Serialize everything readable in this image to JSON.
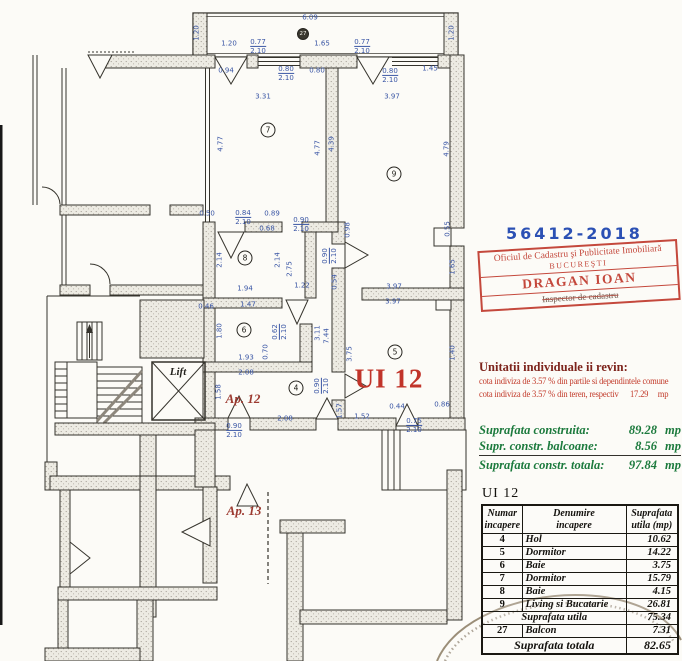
{
  "plan": {
    "labels": [
      {
        "text": "UI 12",
        "x": 389,
        "y": 379,
        "kind": "unit-label"
      },
      {
        "text": "Ap. 12",
        "x": 243,
        "y": 399,
        "kind": "apt-label"
      },
      {
        "text": "Ap. 13",
        "x": 244,
        "y": 511,
        "kind": "apt-label"
      },
      {
        "text": "Lift",
        "x": 178,
        "y": 372,
        "kind": "lift-label"
      }
    ],
    "rooms": [
      {
        "n": "27",
        "x": 303,
        "y": 34
      },
      {
        "n": "7",
        "x": 268,
        "y": 130
      },
      {
        "n": "9",
        "x": 394,
        "y": 174
      },
      {
        "n": "8",
        "x": 245,
        "y": 258
      },
      {
        "n": "6",
        "x": 244,
        "y": 330
      },
      {
        "n": "4",
        "x": 296,
        "y": 388
      },
      {
        "n": "5",
        "x": 395,
        "y": 352
      }
    ],
    "dimensions": [
      {
        "t": "6.09",
        "x": 310,
        "y": 18
      },
      {
        "t": "1.20",
        "x": 197,
        "y": 33,
        "r": 1
      },
      {
        "t": "1.20",
        "x": 452,
        "y": 33,
        "r": 1
      },
      {
        "t": "1.20",
        "x": 229,
        "y": 44
      },
      {
        "t": "0.77",
        "b": "2.10",
        "x": 258,
        "y": 47
      },
      {
        "t": "1.65",
        "x": 322,
        "y": 44
      },
      {
        "t": "0.77",
        "b": "2.10",
        "x": 362,
        "y": 47
      },
      {
        "t": "0.94",
        "x": 226,
        "y": 71
      },
      {
        "t": "0.80",
        "b": "2.10",
        "x": 286,
        "y": 74
      },
      {
        "t": "0.80",
        "x": 317,
        "y": 71
      },
      {
        "t": "0.80",
        "b": "2.10",
        "x": 390,
        "y": 76
      },
      {
        "t": "1.45",
        "x": 430,
        "y": 69
      },
      {
        "t": "3.31",
        "x": 263,
        "y": 97
      },
      {
        "t": "3.97",
        "x": 392,
        "y": 97
      },
      {
        "t": "4.77",
        "x": 221,
        "y": 144,
        "r": 1
      },
      {
        "t": "4.77",
        "x": 318,
        "y": 148,
        "r": 1
      },
      {
        "t": "4.39",
        "x": 332,
        "y": 144,
        "r": 1
      },
      {
        "t": "4.79",
        "x": 447,
        "y": 149,
        "r": 1
      },
      {
        "t": "0.55",
        "x": 448,
        "y": 229,
        "r": 1
      },
      {
        "t": "0.50",
        "x": 207,
        "y": 214
      },
      {
        "t": "0.84",
        "b": "2.10",
        "x": 243,
        "y": 218
      },
      {
        "t": "0.89",
        "x": 272,
        "y": 214
      },
      {
        "t": "0.68",
        "x": 267,
        "y": 229
      },
      {
        "t": "0.90",
        "b": "2.10",
        "x": 301,
        "y": 225
      },
      {
        "t": "0.98",
        "x": 348,
        "y": 230,
        "r": 1
      },
      {
        "t": "2.14",
        "x": 220,
        "y": 260,
        "r": 1
      },
      {
        "t": "2.14",
        "x": 278,
        "y": 260,
        "r": 1
      },
      {
        "t": "2.75",
        "x": 290,
        "y": 269,
        "r": 1
      },
      {
        "t": "0.90",
        "b": "2.10",
        "x": 330,
        "y": 256,
        "r": 1
      },
      {
        "t": "1.94",
        "x": 245,
        "y": 289
      },
      {
        "t": "1.22",
        "x": 302,
        "y": 286
      },
      {
        "t": "0.54",
        "x": 335,
        "y": 282,
        "r": 1
      },
      {
        "t": "1.47",
        "x": 248,
        "y": 305
      },
      {
        "t": "0.46",
        "x": 206,
        "y": 307
      },
      {
        "t": "1.80",
        "x": 220,
        "y": 331,
        "r": 1
      },
      {
        "t": "0.62",
        "b": "2.10",
        "x": 280,
        "y": 332,
        "r": 1
      },
      {
        "t": "0.70",
        "x": 266,
        "y": 352,
        "r": 1
      },
      {
        "t": "3.11",
        "x": 318,
        "y": 333,
        "r": 1
      },
      {
        "t": "7.44",
        "x": 327,
        "y": 336,
        "r": 1
      },
      {
        "t": "1.93",
        "x": 246,
        "y": 358
      },
      {
        "t": "2.08",
        "x": 246,
        "y": 373
      },
      {
        "t": "3.97",
        "x": 394,
        "y": 287
      },
      {
        "t": "3.97",
        "x": 393,
        "y": 302
      },
      {
        "t": "3.75",
        "x": 350,
        "y": 354,
        "r": 1
      },
      {
        "t": "1.40",
        "x": 453,
        "y": 353,
        "r": 1
      },
      {
        "t": "1.65",
        "x": 453,
        "y": 267,
        "r": 1
      },
      {
        "t": "0.90",
        "b": "2.10",
        "x": 322,
        "y": 386,
        "r": 1
      },
      {
        "t": "1.58",
        "x": 219,
        "y": 392,
        "r": 1
      },
      {
        "t": "1.57",
        "x": 340,
        "y": 411,
        "r": 1
      },
      {
        "t": "0.44",
        "x": 397,
        "y": 407
      },
      {
        "t": "0.86",
        "x": 442,
        "y": 405
      },
      {
        "t": "1.52",
        "x": 362,
        "y": 417
      },
      {
        "t": "2.08",
        "x": 285,
        "y": 419
      },
      {
        "t": "0.75",
        "b": "2.10",
        "x": 414,
        "y": 426
      },
      {
        "t": "0.90",
        "b": "2.10",
        "x": 234,
        "y": 431
      }
    ]
  },
  "stamp": {
    "number": "56412-2018",
    "office_line1": "Oficiul de Cadastru şi Publicitate Imobiliară",
    "office_line2": "BUCUREŞTI",
    "name": "DRAGAN IOAN",
    "role": "Inspector de cadastru"
  },
  "allocation": {
    "title": "Unitatii individuale ii revin:",
    "line1": "cota indiviza de  3.57 % din partile si dependintele comune",
    "line2_pre": "cota indiviza de  3.57 % din teren, respectiv",
    "line2_val": "17.29",
    "line2_unit": "mp"
  },
  "areas": {
    "rows": [
      {
        "label": "Suprafata construita:",
        "value": "89.28",
        "unit": "mp"
      },
      {
        "label": "Supr. constr. balcoane:",
        "value": "8.56",
        "unit": "mp"
      }
    ],
    "total": {
      "label": "Suprafata constr. totala:",
      "value": "97.84",
      "unit": "mp"
    }
  },
  "table": {
    "caption": "UI 12",
    "headers": [
      [
        "Numar",
        "incapere"
      ],
      [
        "Denumire",
        "incapere"
      ],
      [
        "Suprafata",
        "utila (mp)"
      ]
    ],
    "rows": [
      {
        "num": "4",
        "name": "Hol",
        "value": "10.62"
      },
      {
        "num": "5",
        "name": "Dormitor",
        "value": "14.22"
      },
      {
        "num": "6",
        "name": "Baie",
        "value": "3.75"
      },
      {
        "num": "7",
        "name": "Dormitor",
        "value": "15.79"
      },
      {
        "num": "8",
        "name": "Baie",
        "value": "4.15"
      },
      {
        "num": "9",
        "name": "Living si Bucatarie",
        "value": "26.81"
      },
      {
        "merged": true,
        "name": "Suprafata utila",
        "value": "75.34"
      },
      {
        "num": "27",
        "name": "Balcon",
        "value": "7.31"
      },
      {
        "merged": true,
        "total": true,
        "name": "Suprafata totala",
        "value": "82.65"
      }
    ]
  }
}
